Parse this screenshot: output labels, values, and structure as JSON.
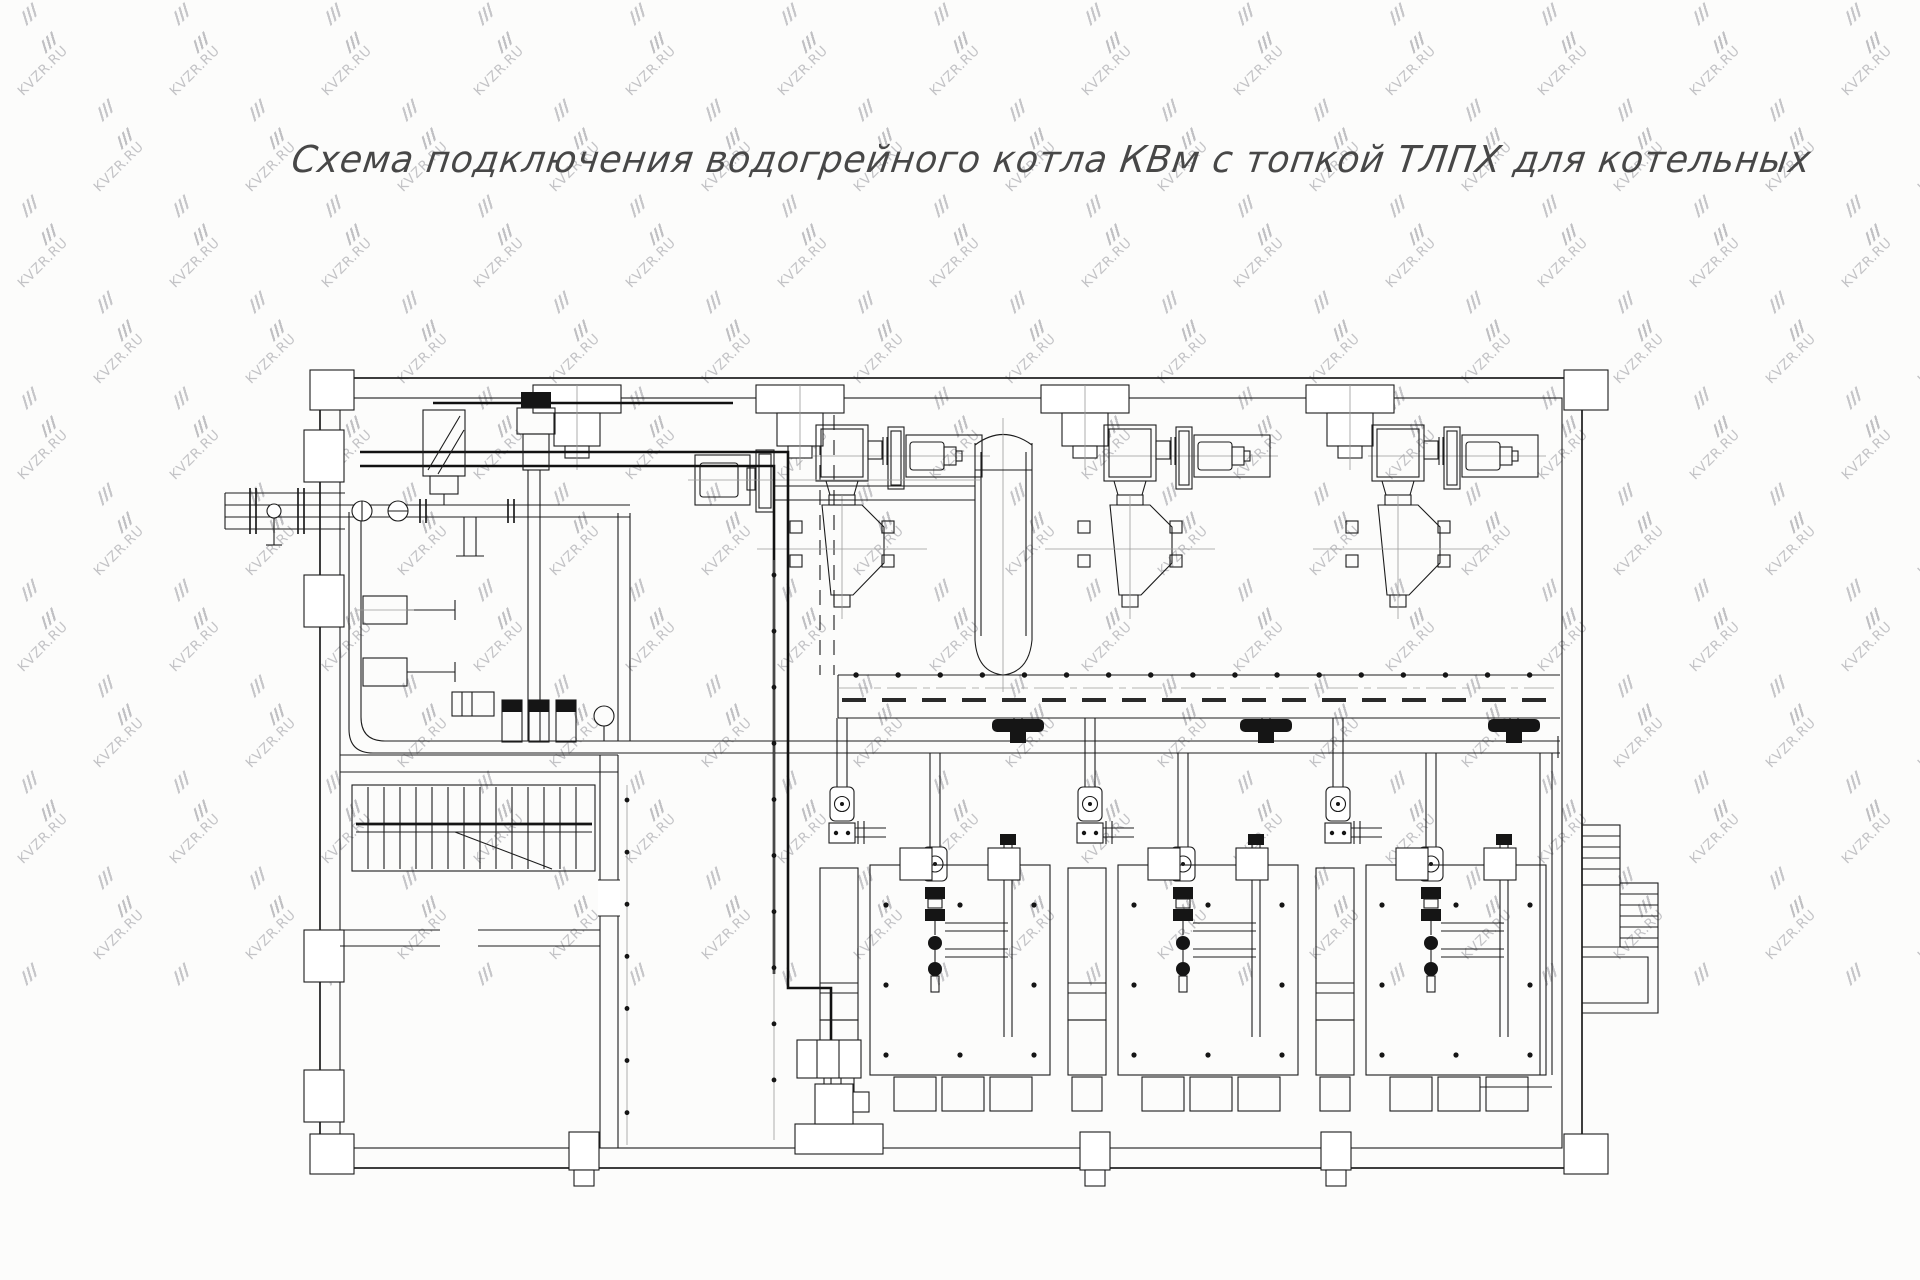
{
  "header": {
    "title": "Схема подключения водогрейного котла КВм с топкой ТЛПХ  для котельных"
  },
  "watermark": {
    "text": "KVZR.RU"
  },
  "colors": {
    "background": "#fcfcfb",
    "line": "#1c1c1c",
    "bold_line": "#111111",
    "centerline": "#9a9a9a",
    "title_text": "#474747",
    "watermark": "#c3c3c6"
  }
}
